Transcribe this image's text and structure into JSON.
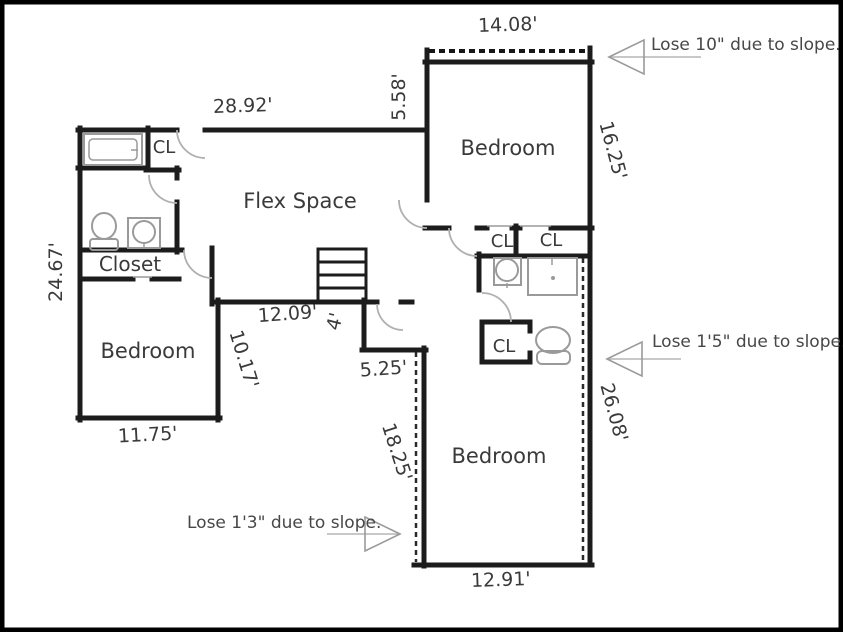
{
  "plan": {
    "rooms": {
      "flex": "Flex Space",
      "bedroom_top": "Bedroom",
      "bedroom_left": "Bedroom",
      "bedroom_bottom": "Bedroom",
      "closet_left": "Closet",
      "cl_top_left": "CL",
      "cl_hall_1": "CL",
      "cl_hall_2": "CL",
      "cl_bottom": "CL"
    },
    "dims": {
      "top_bedroom_width": "14.08'",
      "flex_top_width": "28.92'",
      "top_bedroom_left_height": "5.58'",
      "top_bedroom_right_height": "16.25'",
      "left_wall_height": "24.67'",
      "under_stairs_width": "12.09'",
      "hall_step_depth": "4'",
      "left_bedroom_right_height": "10.17'",
      "hall_bottom_width": "5.25'",
      "left_bedroom_width": "11.75'",
      "bottom_bedroom_left_height": "18.25'",
      "bottom_bedroom_right_height": "26.08'",
      "bottom_bedroom_width": "12.91'"
    },
    "notes": {
      "slope_top": "Lose 10\" due to slope.",
      "slope_right": "Lose 1'5\" due to slope.",
      "slope_bottom": "Lose 1'3\" due to slope."
    },
    "colors": {
      "wall": "#1c1c1c",
      "fixture": "#9a9a9a",
      "text": "#3a3a3a",
      "background": "#ffffff",
      "frame": "#000000"
    }
  }
}
